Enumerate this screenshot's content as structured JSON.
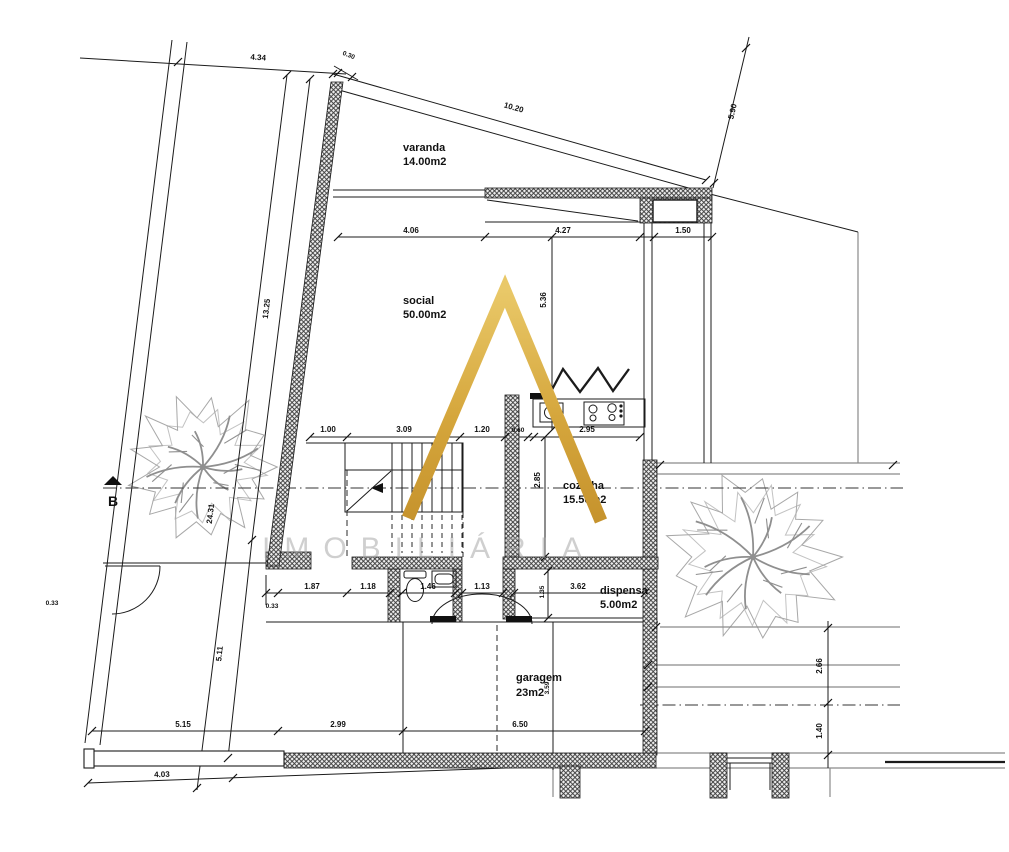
{
  "drawing": {
    "type": "floor-plan",
    "section_label": "B"
  },
  "watermark": {
    "text": "IMOBILIÁRIA",
    "logo_letter": "A",
    "gold_color": "#D5A63C",
    "text_color": "#9f9f9f"
  },
  "rooms": [
    {
      "name": "varanda",
      "area": "14.00m2"
    },
    {
      "name": "social",
      "area": "50.00m2"
    },
    {
      "name": "cozinha",
      "area": "15.50m2"
    },
    {
      "name": "dispensa",
      "area": "5.00m2"
    },
    {
      "name": "garagem",
      "area": "23m2"
    }
  ],
  "dimensions": {
    "d434": "4.34",
    "d030": "0.30",
    "d1020": "10.20",
    "d590": "5.90",
    "d406": "4.06",
    "d427": "4.27",
    "d150": "1.50",
    "d536": "5.36",
    "d100": "1.00",
    "d309": "3.09",
    "d120": "1.20",
    "d060": "0.60",
    "d295": "2.95",
    "d285": "2.85",
    "d1325": "13.25",
    "d2431": "24.31",
    "d511": "5.11",
    "d033a": "0.33",
    "d033b": "0.33",
    "d187": "1.87",
    "d118": "1.18",
    "d146": "1.46",
    "d113": "1.13",
    "d135": "1.35",
    "d362": "3.62",
    "d515": "5.15",
    "d299": "2.99",
    "d650": "6.50",
    "d403": "4.03",
    "d359": "3.59",
    "d266": "2.66",
    "d140": "1.40"
  }
}
